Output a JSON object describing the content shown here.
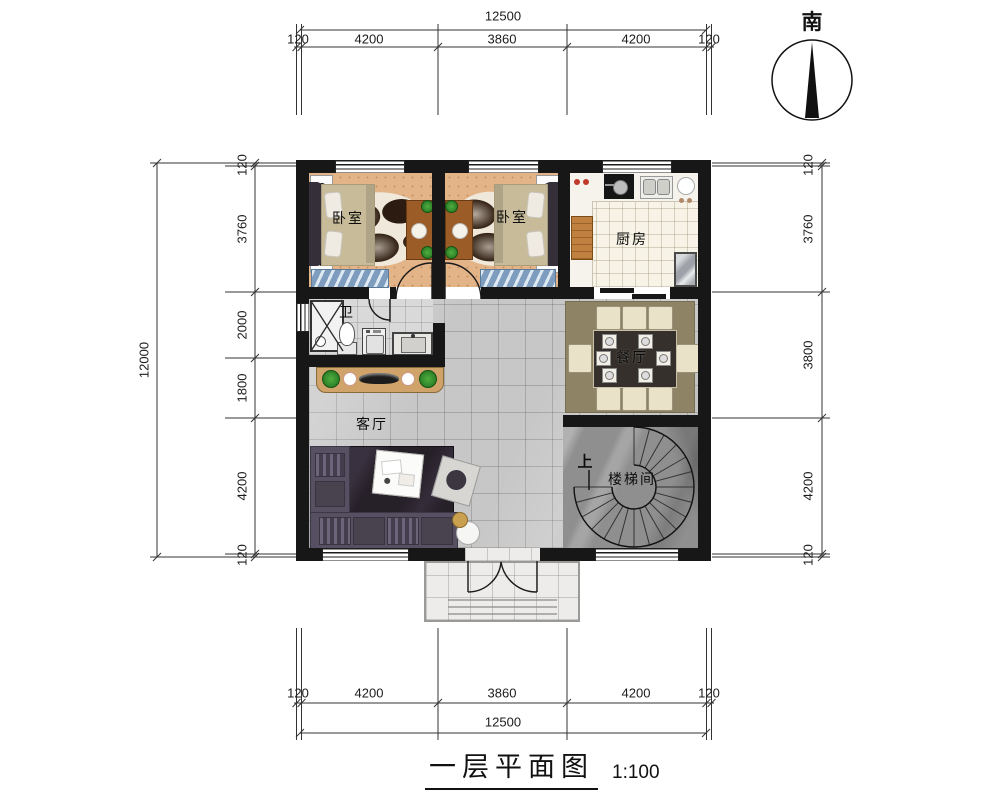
{
  "title": {
    "main": "一层平面图",
    "scale": "1:100"
  },
  "compass": {
    "label": "南"
  },
  "rooms": {
    "bedroom1": "卧室",
    "bedroom2": "卧室",
    "kitchen": "厨房",
    "bath": "卫",
    "living": "客厅",
    "dining": "餐厅",
    "stair": "楼梯间",
    "up": "上"
  },
  "dimensions": {
    "top": {
      "total": "12500",
      "segments": [
        "120",
        "4200",
        "3860",
        "4200",
        "120"
      ]
    },
    "bottom": {
      "total": "12500",
      "segments": [
        "120",
        "4200",
        "3860",
        "4200",
        "120"
      ]
    },
    "left": {
      "total": "12000",
      "segments": [
        "120",
        "3760",
        "2000",
        "1800",
        "4200",
        "120"
      ]
    },
    "right": {
      "segments": [
        "120",
        "3760",
        "3800",
        "4200",
        "120"
      ]
    }
  },
  "colors": {
    "wall": "#171717",
    "bedroom_floor": "#e3b488",
    "kitchen_floor": "#f7f3e7",
    "tile_floor": "#c7c7c7",
    "marble_floor": "#8f8f8f",
    "dining_rug": "#8e8365",
    "wood_accent": "#cfa36a"
  }
}
